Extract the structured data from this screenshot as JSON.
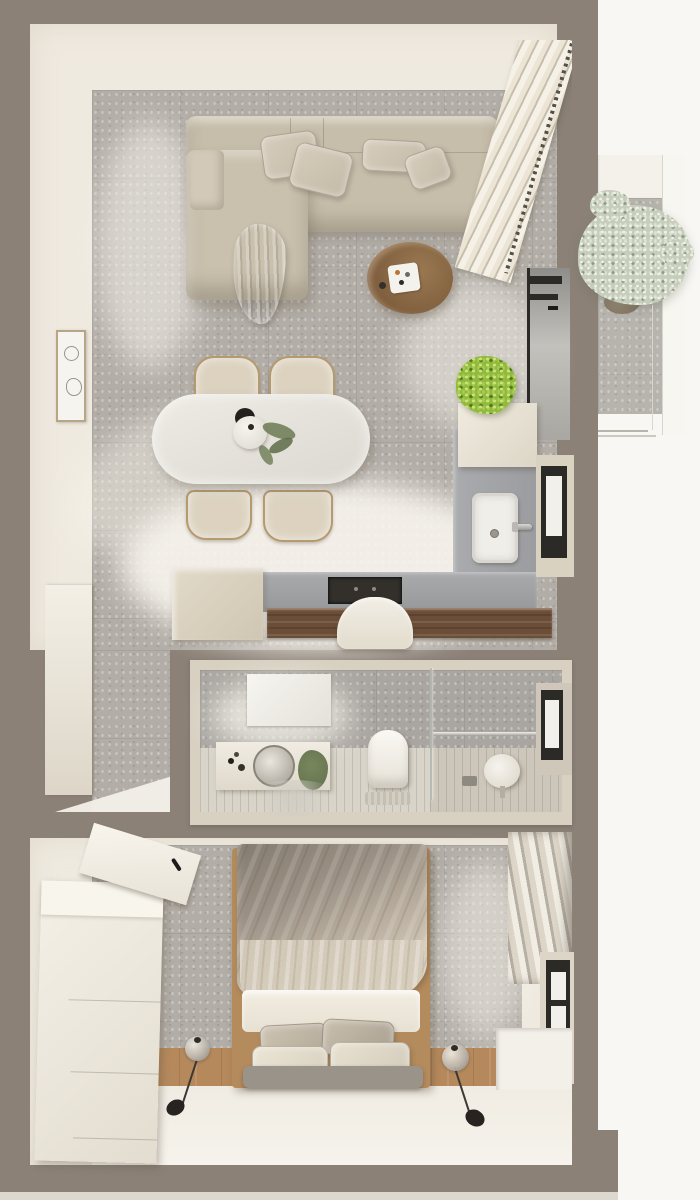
{
  "scene": {
    "title": "Apartment floor plan — top-down 3D render",
    "description": "Photoreal top view of a small apartment: living-dining room with kitchen, bathroom, bedroom, and balcony niche with olive tree",
    "style": "neutral beige, taupe and gray architectural visualization, strong sunlight from the right windows"
  },
  "palette": {
    "outer_wall": "#8b8177",
    "exterior": "#f8f7f4",
    "interior_wall_face": "#efeae0",
    "concrete_floor": "#b2ada6",
    "sunlit_floor": "#f4f1e9",
    "sofa_beige": "#c6bdab",
    "coffee_table_walnut": "#8a6a4c",
    "dining_table": "#e7e4dd",
    "counter_gray": "#9fa0a2",
    "cooktop_black": "#33302c",
    "breakfast_bar_walnut": "#6b4e38",
    "bathroom_frame_cream": "#d8d1c2",
    "plank_floor": "#d9d4c9",
    "bed_duvet_gray": "#9a9084",
    "bed_sheet_white": "#efeade",
    "bedroom_oak_floor": "#b5895c",
    "window_frame_black": "#2c2a27",
    "kitchen_plant_green": "#8fba3c",
    "olive_foliage_sage": "#c7cdbc"
  },
  "rooms": {
    "living_dining": {
      "label": "Living & dining room"
    },
    "kitchen": {
      "label": "Kitchen"
    },
    "hallway": {
      "label": "Entry hallway"
    },
    "bathroom": {
      "label": "Bathroom"
    },
    "bedroom": {
      "label": "Bedroom"
    },
    "balcony": {
      "label": "Balcony niche"
    }
  },
  "furniture": {
    "sofa": "Beige sectional sofa with chaise",
    "sofa_cushion": "Back cushion",
    "throw": "Draped throw blanket",
    "coffee_table": "Round walnut coffee table with tray",
    "dining_table": "Oval white dining table",
    "dining_chair": "Wood-frame dining chair",
    "table_bowl": "Black decorative bowl",
    "table_vase": "White vase with greenery",
    "wall_art": "Framed wall art",
    "blinds": "Roman blinds",
    "living_window": "Living room window",
    "base_cabinet": "Kitchen base cabinet",
    "counter": "Kitchen countertop",
    "cooktop": "Built-in cooktop",
    "sink": "Kitchen sink with faucet",
    "wall_cabinet": "Kitchen wall cabinet",
    "kitchen_plant": "Potted green plant",
    "breakfast_bar": "Walnut breakfast bar",
    "bar_stool": "White bar stool",
    "kitchen_window": "Kitchen window",
    "entry_door": "Open entry door",
    "vanity": "Bathroom vanity",
    "round_mirror": "Round vanity mirror",
    "wall_mirror": "Bathroom wall mirror",
    "toilet": "Wall-hung toilet",
    "partition": "Glass shower partition",
    "towel_rail": "Towel rail",
    "shower_stool": "Round shower stool",
    "bathroom_window": "Bathroom window",
    "dresser": "White bedroom dresser",
    "leaning_mirror": "Leaning mirror panel",
    "bed": "Double bed with wood frame",
    "duvet": "Gray velvet duvet",
    "sheet": "White sheet",
    "bed_pillow": "Bed pillow",
    "bench": "Bed-end bench",
    "pendant": "Glass pendant lamp",
    "curtains": "Bedroom curtains",
    "bedroom_window": "Bedroom window",
    "window_sill": "Window sill ledge",
    "olive_tree": "Olive tree in planter",
    "ledge": "Balcony ledge"
  }
}
